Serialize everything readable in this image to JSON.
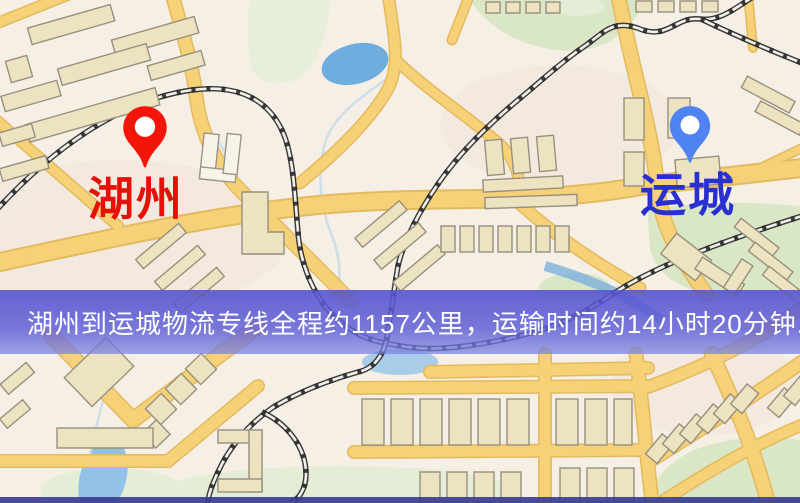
{
  "image_size": {
    "width": 800,
    "height": 503
  },
  "markers": {
    "origin": {
      "name": "湖州",
      "pin_icon": "red-location-pin",
      "pin_color": "#f31509",
      "label_color": "#e51008"
    },
    "destination": {
      "name": "运城",
      "pin_icon": "blue-location-pin",
      "pin_color": "#4f83f2",
      "label_color": "#2a2fd2"
    }
  },
  "banner": {
    "text": "湖州到运城物流专线全程约1157公里，运输时间约14小时20分钟.",
    "background_color": "#5b59d1",
    "text_color": "#ffffff"
  },
  "map_palette": {
    "background": "#f6efe5",
    "road_fill": "#f6d178",
    "road_casing": "#e3ba5e",
    "railway": "#2b2b2b",
    "water_lake": "#6fadde",
    "water_pale": "#a9cce8",
    "park_green": "#d9e7c6",
    "building_fill": "#eee3c0",
    "building_stroke": "#97907f",
    "bottom_strip": "#3b3e90"
  }
}
